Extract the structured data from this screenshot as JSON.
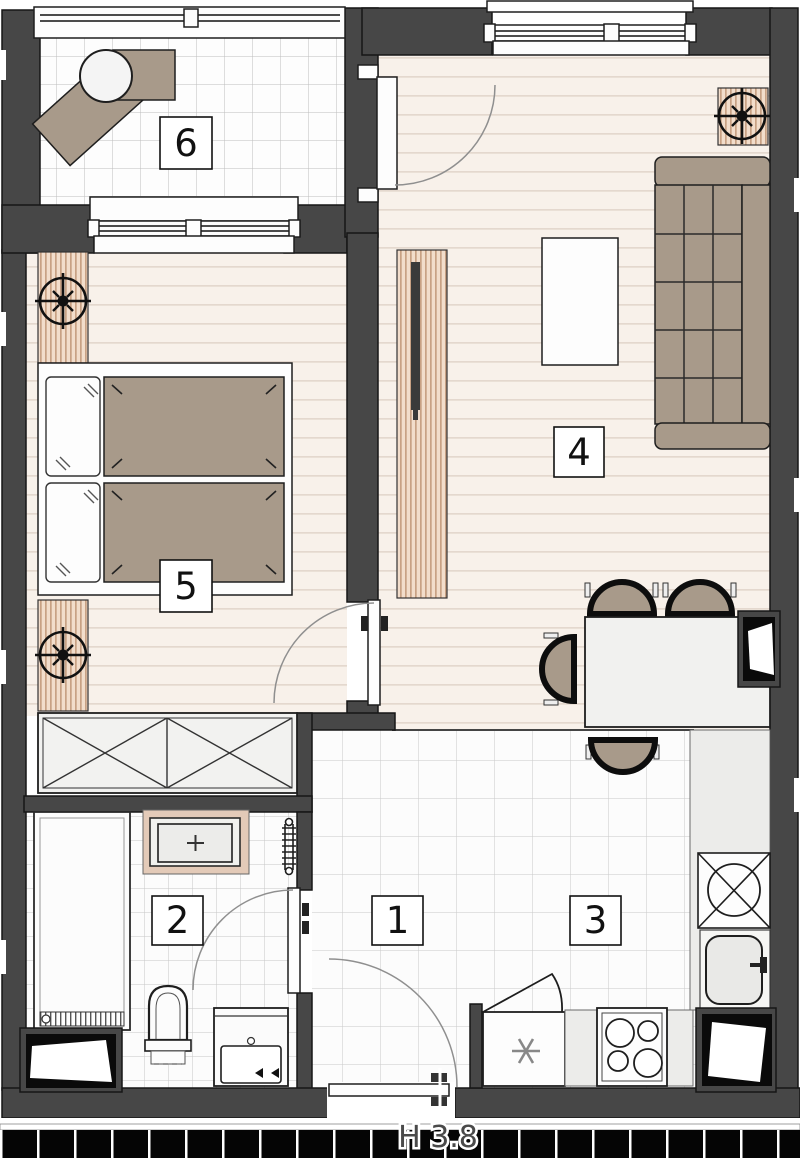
{
  "plan": {
    "type": "apartment-floor-plan",
    "room_labels": {
      "hallway": "1",
      "bathroom": "2",
      "kitchen": "3",
      "living_room": "4",
      "bedroom": "5",
      "balcony": "6"
    },
    "annotations": {
      "entrance_note": "H 3.8"
    },
    "colors": {
      "wall": "#474747",
      "outline": "#161616",
      "furniture_tan": "#a89a8a",
      "radiator_stripe_bg": "#f2ddcb",
      "radiator_stripe_line": "#c8a184",
      "wood_floor_bg": "#f8f1ea",
      "wood_floor_line": "#e4d8ce",
      "tile_bg": "#fcfcfc",
      "tile_line": "#c9c9c9",
      "counter_gray": "#ececea",
      "shaft_black": "#0a0a0a"
    }
  }
}
